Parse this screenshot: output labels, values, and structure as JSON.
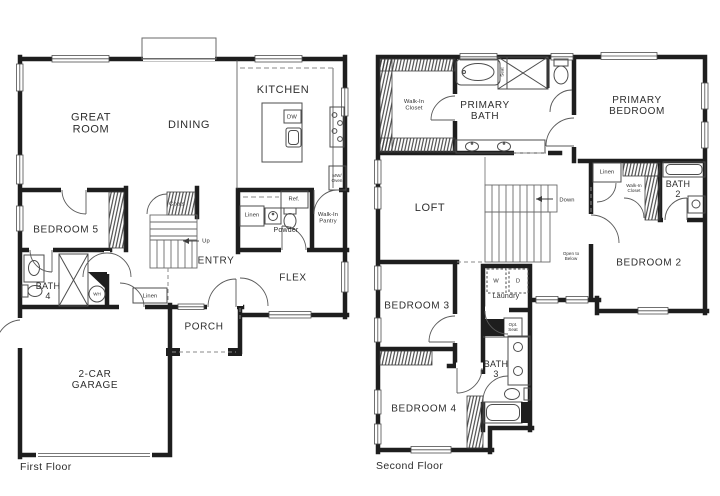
{
  "colors": {
    "wall": "#1e1e1e",
    "fixture_line": "#4d4d4d",
    "text": "#2e2e2e",
    "background": "#ffffff"
  },
  "first_floor": {
    "caption": "First Floor",
    "labels": {
      "great_room": "GREAT\nROOM",
      "dining": "DINING",
      "kitchen": "KITCHEN",
      "bedroom_5": "BEDROOM 5",
      "bath_4": "BATH\n4",
      "entry": "ENTRY",
      "flex": "FLEX",
      "porch": "PORCH",
      "garage": "2-CAR\nGARAGE",
      "powder": "Powder",
      "pantry": "Walk-In\nPantry",
      "coats": "Coats",
      "linen_powder": "Linen",
      "linen_hall": "Linen",
      "ref": "Ref.",
      "dw": "DW",
      "mw_oven": "MW/\nOven",
      "wh": "WH",
      "up": "Up"
    }
  },
  "second_floor": {
    "caption": "Second Floor",
    "labels": {
      "primary_bedroom": "PRIMARY\nBEDROOM",
      "primary_bath": "PRIMARY\nBATH",
      "primary_closet": "Walk-In\nCloset",
      "shower_seat": "Seat",
      "loft": "LOFT",
      "down": "Down",
      "open_to_below": "Open to\nBelow",
      "bedroom_2": "BEDROOM 2",
      "bedroom_2_closet": "Walk-In\nCloset",
      "bath_2": "BATH\n2",
      "linen": "Linen",
      "bedroom_3": "BEDROOM 3",
      "bedroom_4": "BEDROOM 4",
      "bath_3": "BATH\n3",
      "laundry": "Laundry",
      "washer": "W",
      "dryer": "D",
      "opt_seat": "Opt.\nSeat"
    }
  }
}
